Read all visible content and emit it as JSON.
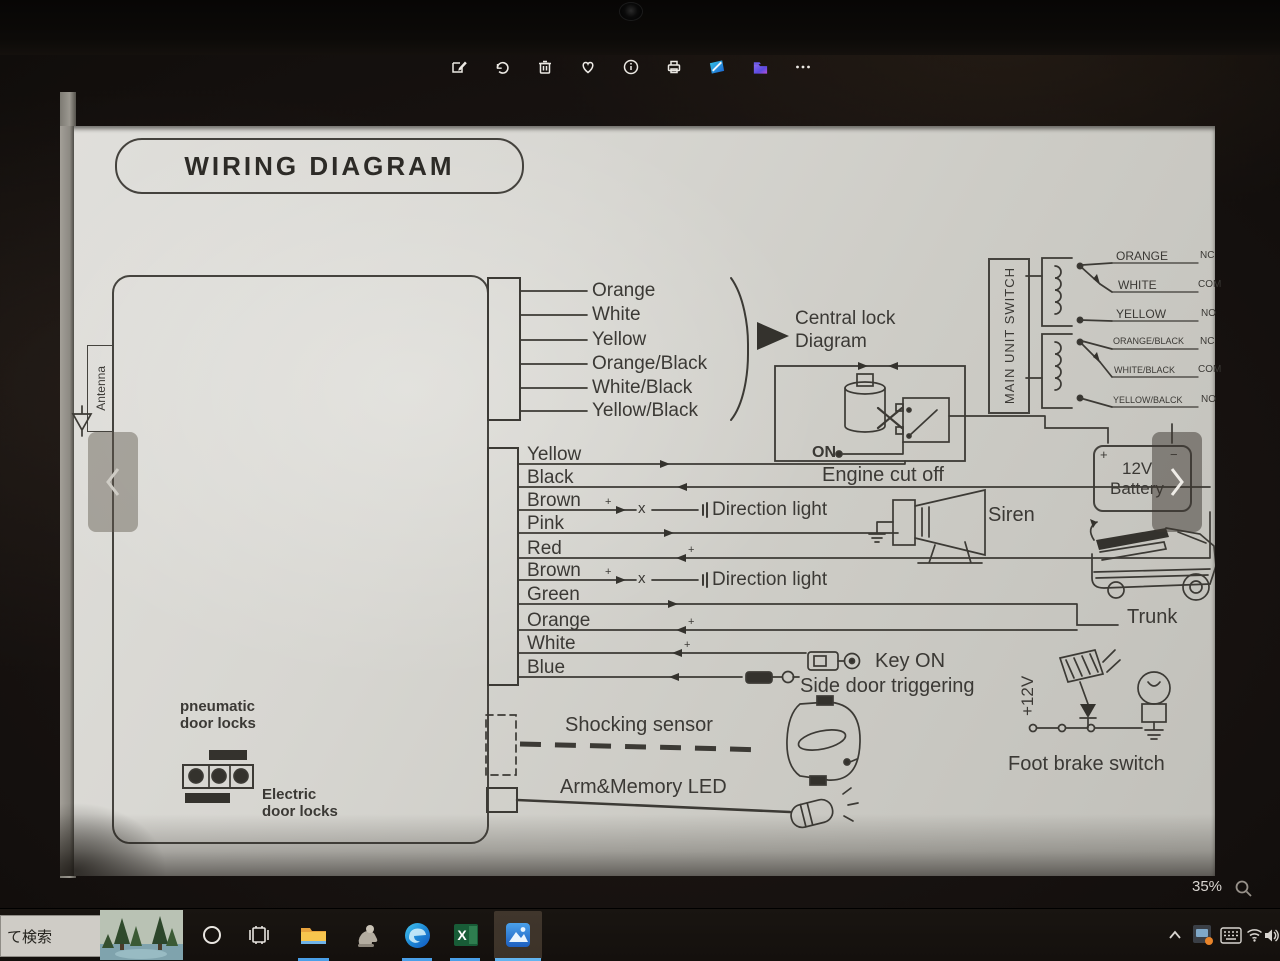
{
  "photos_app": {
    "toolbar_icons": [
      "edit-icon",
      "rotate-icon",
      "delete-icon",
      "favorite-icon",
      "info-icon",
      "print-icon",
      "edit-3d-icon",
      "open-with-icon",
      "see-more-icon"
    ],
    "zoom_level": "35%"
  },
  "diagram": {
    "title": "WIRING DIAGRAM",
    "antenna": "Antenna",
    "top_connector_wires": [
      "Orange",
      "White",
      "Yellow",
      "Orange/Black",
      "White/Black",
      "Yellow/Black"
    ],
    "central_lock": {
      "line1": "Central lock",
      "line2": "Diagram"
    },
    "engine": {
      "on": "ON",
      "label": "Engine cut off"
    },
    "main_unit_switch": "MAIN UNIT SWITCH",
    "switch_rows": [
      {
        "wire": "ORANGE",
        "terminal": "NC"
      },
      {
        "wire": "WHITE",
        "terminal": "COM"
      },
      {
        "wire": "YELLOW",
        "terminal": "NO"
      },
      {
        "wire": "ORANGE/BLACK",
        "terminal": "NC"
      },
      {
        "wire": "WHITE/BLACK",
        "terminal": "COM"
      },
      {
        "wire": "YELLOW/BALCK",
        "terminal": "NO"
      }
    ],
    "battery": {
      "plus": "+",
      "minus": "−",
      "line1": "12V",
      "line2": "Battery"
    },
    "harness_wires": [
      "Yellow",
      "Black",
      "Brown",
      "Pink",
      "Red",
      "Brown",
      "Green",
      "Orange",
      "White",
      "Blue"
    ],
    "break_mark": "x",
    "plus_mark": "+",
    "direction_light": "Direction light",
    "siren": "Siren",
    "trunk": "Trunk",
    "key_on": "Key ON",
    "side_door": "Side door triggering",
    "plus_12v": "+12V",
    "foot_brake": "Foot brake switch",
    "shocking_sensor": "Shocking sensor",
    "arm_memory_led": "Arm&Memory LED",
    "pneumatic": {
      "line1": "pneumatic",
      "line2": "door locks"
    },
    "electric": {
      "line1": "Electric",
      "line2": "door locks"
    }
  },
  "taskbar": {
    "search_text": "て検索"
  }
}
